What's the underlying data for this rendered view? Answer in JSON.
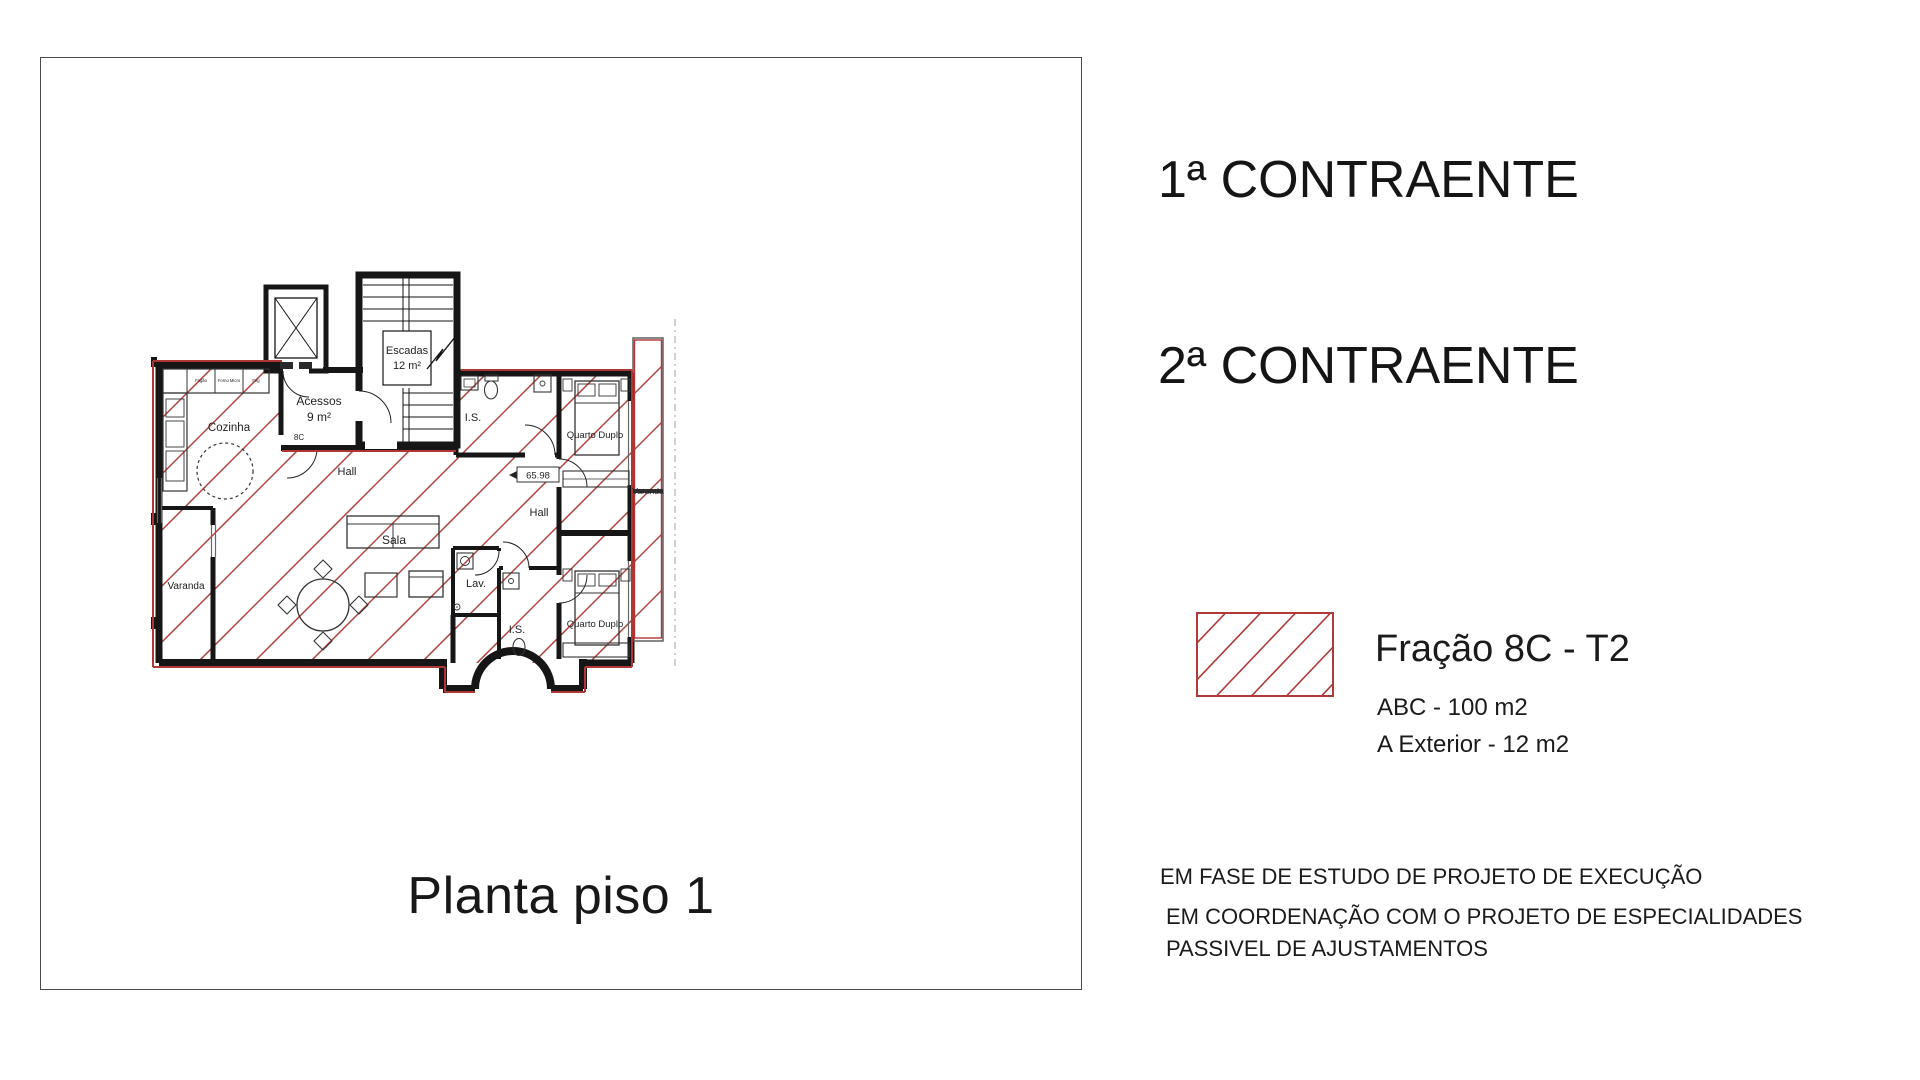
{
  "title": "Planta piso 1",
  "parties": {
    "first": "1ª CONTRAENTE",
    "second": "2ª CONTRAENTE"
  },
  "legend": {
    "fraction": "Fração 8C - T2",
    "area_abc": "ABC - 100 m2",
    "area_exterior": "A Exterior - 12 m2",
    "hatch_color": "#b03a3a"
  },
  "notes": [
    "EM FASE DE ESTUDO DE PROJETO DE EXECUÇÃO",
    "EM COORDENAÇÃO COM O PROJETO DE ESPECIALIDADES",
    "PASSIVEL DE AJUSTAMENTOS"
  ],
  "plan": {
    "rooms": {
      "escadas": "Escadas",
      "escadas_area": "12 m²",
      "acessos": "Acessos",
      "acessos_area": "9 m²",
      "unit_door": "8C",
      "cozinha": "Cozinha",
      "hall1": "Hall",
      "hall2": "Hall",
      "sala": "Sala",
      "lav": "Lav.",
      "is_top": "I.S.",
      "is_bottom": "I.S.",
      "quarto_top": "Quarto Duplo",
      "quarto_bottom": "Quarto Duplo",
      "varanda_left": "Varanda",
      "varanda_right": "Varanda"
    },
    "level_mark": "65.98",
    "kitchen_appliances": [
      "Fogão",
      "Forno Micro",
      "Frig"
    ],
    "colors": {
      "wall": "#161616",
      "boundary_red": "#b03535",
      "hatch_red": "#b24040"
    }
  }
}
